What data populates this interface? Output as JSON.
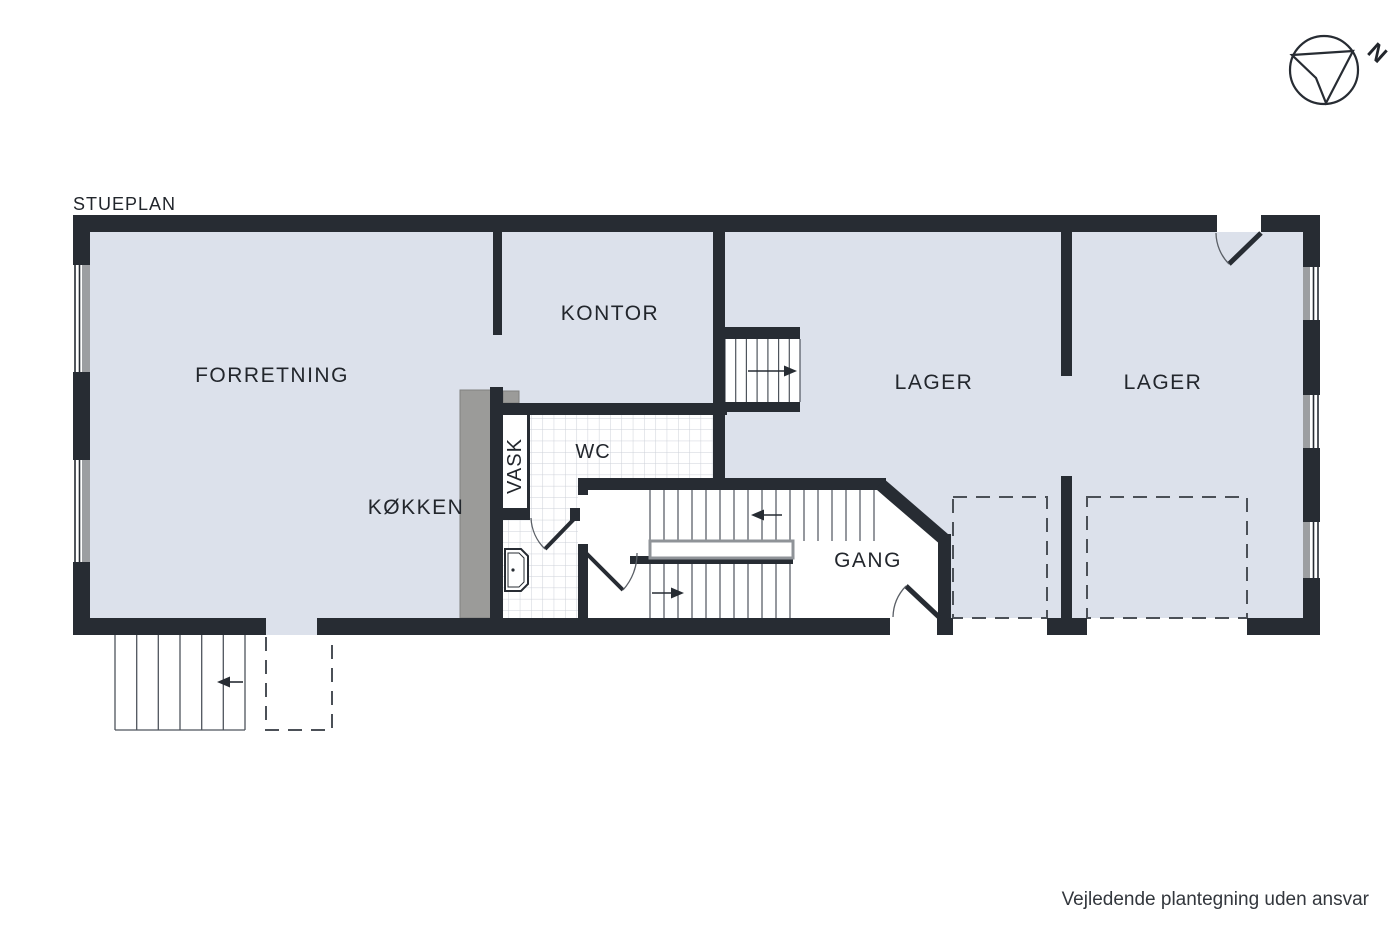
{
  "title": "STUEPLAN",
  "rooms": {
    "forretning": {
      "label": "FORRETNING"
    },
    "kontor": {
      "label": "KONTOR"
    },
    "vask": {
      "label": "VASK"
    },
    "wc": {
      "label": "WC"
    },
    "koekken": {
      "label": "KØKKEN"
    },
    "gang": {
      "label": "GANG"
    },
    "lager1": {
      "label": "LAGER"
    },
    "lager2": {
      "label": "LAGER"
    }
  },
  "compass": {
    "north_label": "N"
  },
  "footer": {
    "disclaimer": "Vejledende plantegning uden ansvar"
  },
  "colors": {
    "floor": "#dce1eb",
    "wall": "#272c33",
    "counter": "#9b9b99",
    "window_frame": "#9c9ea1",
    "tile_line": "#cdd1d8",
    "step_line": "#4e545c",
    "dash_line": "#4b5057",
    "text": "#22262c"
  }
}
